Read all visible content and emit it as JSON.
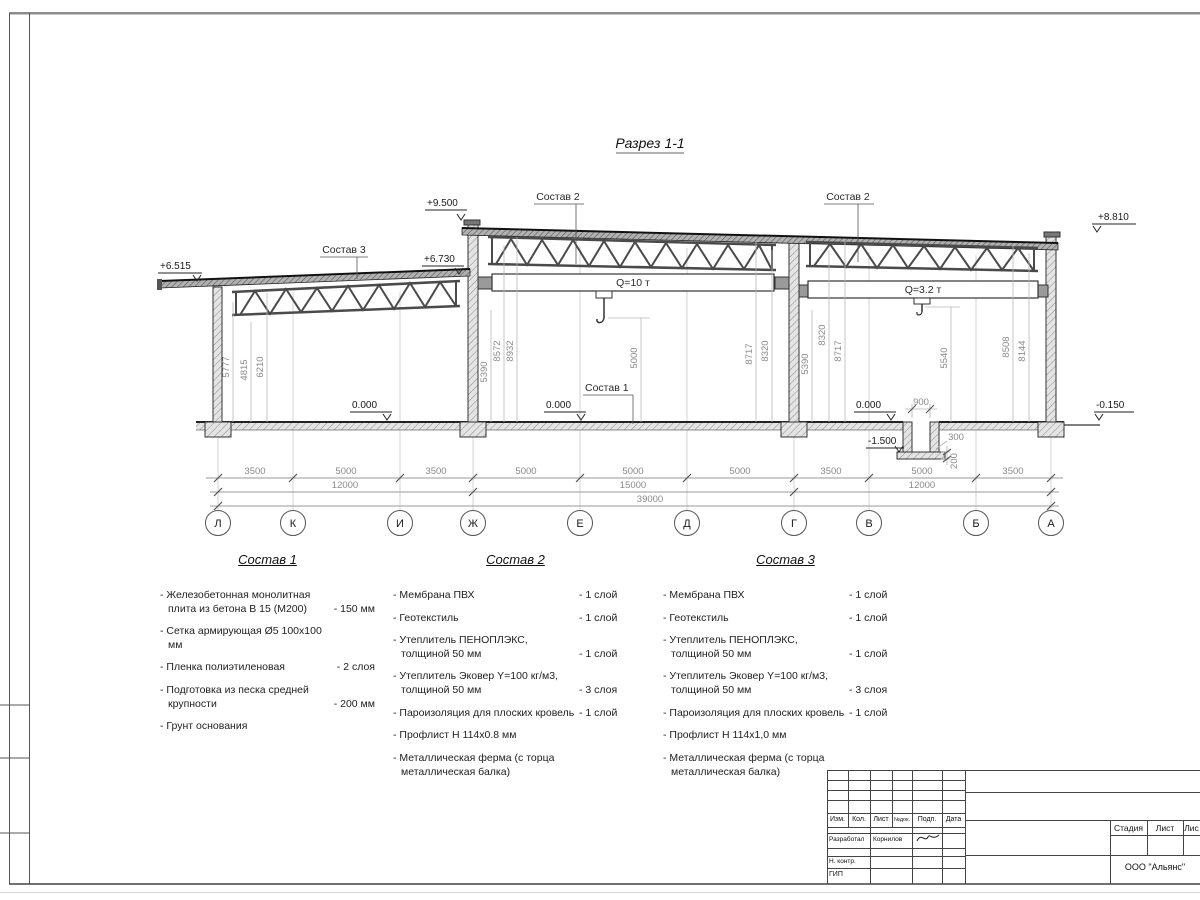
{
  "drawing": {
    "title": "Разрез 1-1",
    "section_labels": {
      "sostav1": "Состав 1",
      "sostav2_mid": "Состав 2",
      "sostav2_right": "Состав 2",
      "sostav3": "Состав 3",
      "crane_mid": "Q=10 т",
      "crane_right": "Q=3.2 т"
    },
    "elevations": {
      "low_left": "+6.515",
      "low_right": "+6.730",
      "high_left": "+9.500",
      "high_right": "+8.810",
      "floor_left": "0.000",
      "floor_mid": "0.000",
      "floor_right": "0.000",
      "pit": "-1.500",
      "grade_right": "-0.150"
    },
    "vertical_dims": [
      "5777",
      "4815",
      "6210",
      "5390",
      "8572",
      "8932",
      "5000",
      "8717",
      "8320",
      "5390",
      "8320",
      "8717",
      "5540",
      "8508",
      "8144"
    ],
    "pit_dims": {
      "width": "900",
      "wall": "300",
      "slab": "200"
    },
    "axis_row1": [
      "3500",
      "5000",
      "3500",
      "5000",
      "5000",
      "5000",
      "3500",
      "5000",
      "3500"
    ],
    "axis_row2": [
      "12000",
      "15000",
      "12000"
    ],
    "axis_total": "39000",
    "axes": [
      "Л",
      "К",
      "И",
      "Ж",
      "Е",
      "Д",
      "Г",
      "В",
      "Б",
      "А"
    ]
  },
  "compositions": [
    {
      "title": "Состав 1",
      "items": [
        {
          "name": "- Железобетонная  монолитная плита из бетона В 15 (М200)",
          "value": "- 150 мм"
        },
        {
          "name": "- Сетка армирующая Ø5 100х100 мм",
          "value": ""
        },
        {
          "name": "- Пленка полиэтиленовая",
          "value": "- 2 слоя"
        },
        {
          "name": "- Подготовка из песка средней крупности",
          "value": "- 200 мм"
        },
        {
          "name": "- Грунт основания",
          "value": ""
        }
      ]
    },
    {
      "title": "Состав 2",
      "items": [
        {
          "name": "- Мембрана ПВХ",
          "value": "- 1 слой"
        },
        {
          "name": "- Геотекстиль",
          "value": "- 1 слой"
        },
        {
          "name": "- Утеплитель ПЕНОПЛЭКС, толщиной 50 мм",
          "value": "- 1 слой"
        },
        {
          "name": "- Утеплитель Эковер Y=100 кг/м3, толщиной 50 мм",
          "value": "- 3 слоя"
        },
        {
          "name": "- Пароизоляция для плоских кровель",
          "value": "- 1 слой"
        },
        {
          "name": "- Профлист Н 114х0.8 мм",
          "value": ""
        },
        {
          "name": "- Металлическая ферма (с торца металлическая балка)",
          "value": ""
        }
      ]
    },
    {
      "title": "Состав 3",
      "items": [
        {
          "name": "- Мембрана ПВХ",
          "value": "- 1 слой"
        },
        {
          "name": "- Геотекстиль",
          "value": "- 1 слой"
        },
        {
          "name": "- Утеплитель ПЕНОПЛЭКС, толщиной 50 мм",
          "value": "- 1 слой"
        },
        {
          "name": "- Утеплитель Эковер Y=100 кг/м3, толщиной 50 мм",
          "value": "- 3 слоя"
        },
        {
          "name": "- Пароизоляция для плоских кровель",
          "value": "- 1 слой"
        },
        {
          "name": "- Профлист Н 114х1,0 мм",
          "value": ""
        },
        {
          "name": "- Металлическая ферма (с торца металлическая балка)",
          "value": ""
        }
      ]
    }
  ],
  "titleblock": {
    "header_cols": [
      "Изм.",
      "Кол.",
      "Лист",
      "№док.",
      "Подп.",
      "Дата"
    ],
    "developer_role": "Разработал",
    "developer_name": "Корнилов",
    "ncontr": "Н. контр.",
    "gip": "ГИП",
    "stage": "Стадия",
    "sheet": "Лист",
    "sheets": "Лис",
    "company": "ООО \"Альянс\""
  }
}
